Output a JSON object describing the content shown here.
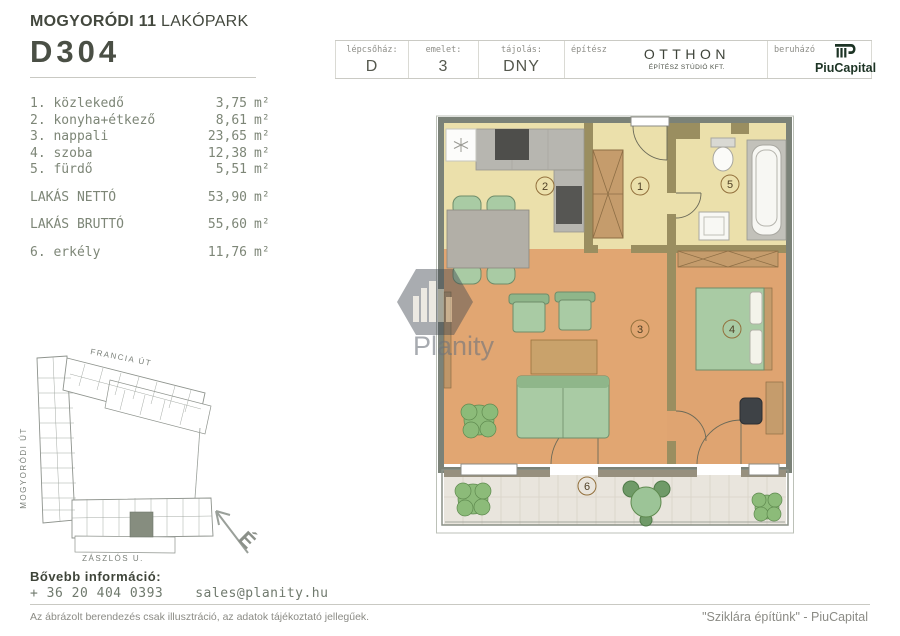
{
  "header": {
    "project_title_bold": "MOGYORÓDI 11",
    "project_title_rest": " LAKÓPARK",
    "unit_id": "D304",
    "cells": [
      {
        "label": "lépcsőház:",
        "value": "D"
      },
      {
        "label": "emelet:",
        "value": "3"
      },
      {
        "label": "tájolás:",
        "value": "DNY"
      }
    ],
    "architect": {
      "label": "építész",
      "name": "OTTHON",
      "subtitle": "ÉPÍTÉSZ STÚDIÓ KFT."
    },
    "developer": {
      "label": "beruházó",
      "name": "PiuCapital"
    }
  },
  "room_list": {
    "rooms": [
      {
        "num": "1.",
        "name": "1. közlekedő",
        "area": "3,75",
        "unit": "m²"
      },
      {
        "num": "2.",
        "name": "2. konyha+étkező",
        "area": "8,61",
        "unit": "m²"
      },
      {
        "num": "3.",
        "name": "3. nappali",
        "area": "23,65",
        "unit": "m²"
      },
      {
        "num": "4.",
        "name": "4. szoba",
        "area": "12,38",
        "unit": "m²"
      },
      {
        "num": "5.",
        "name": "5. fürdő",
        "area": "5,51",
        "unit": "m²"
      }
    ],
    "totals": [
      {
        "name": "LAKÁS NETTÓ",
        "area": "53,90",
        "unit": "m²"
      },
      {
        "name": "LAKÁS BRUTTÓ",
        "area": "55,60",
        "unit": "m²"
      }
    ],
    "balcony": {
      "name": "6. erkély",
      "area": "11,76",
      "unit": "m²"
    }
  },
  "site_plan": {
    "street_top": "FRANCIA ÚT",
    "street_left": "MOGYORÓDI ÚT",
    "street_bottom": "ZÁSZLÓS U.",
    "compass_letter": "É"
  },
  "floor_plan": {
    "room_numbers": [
      "1",
      "2",
      "3",
      "4",
      "5",
      "6"
    ]
  },
  "watermark_text": "Planity",
  "footer": {
    "info_label": "Bővebb információ:",
    "phone": "+ 36 20 404 0393",
    "email": "sales@planity.hu",
    "disclaimer": "Az ábrázolt berendezés csak illusztráció, az adatok tájékoztató jellegűek.",
    "slogan": "\"Sziklára építünk\" - PiuCapital"
  },
  "colors": {
    "brand_dark_green": "#1d3425",
    "text_dark": "#474c43",
    "text_muted": "#7d8677",
    "floor_warm": "#e1a672",
    "floor_pale": "#ebe0ab",
    "wall_olive": "#9a8e60",
    "furniture_green": "#a9cba4",
    "site_highlight": "#868d7f"
  }
}
